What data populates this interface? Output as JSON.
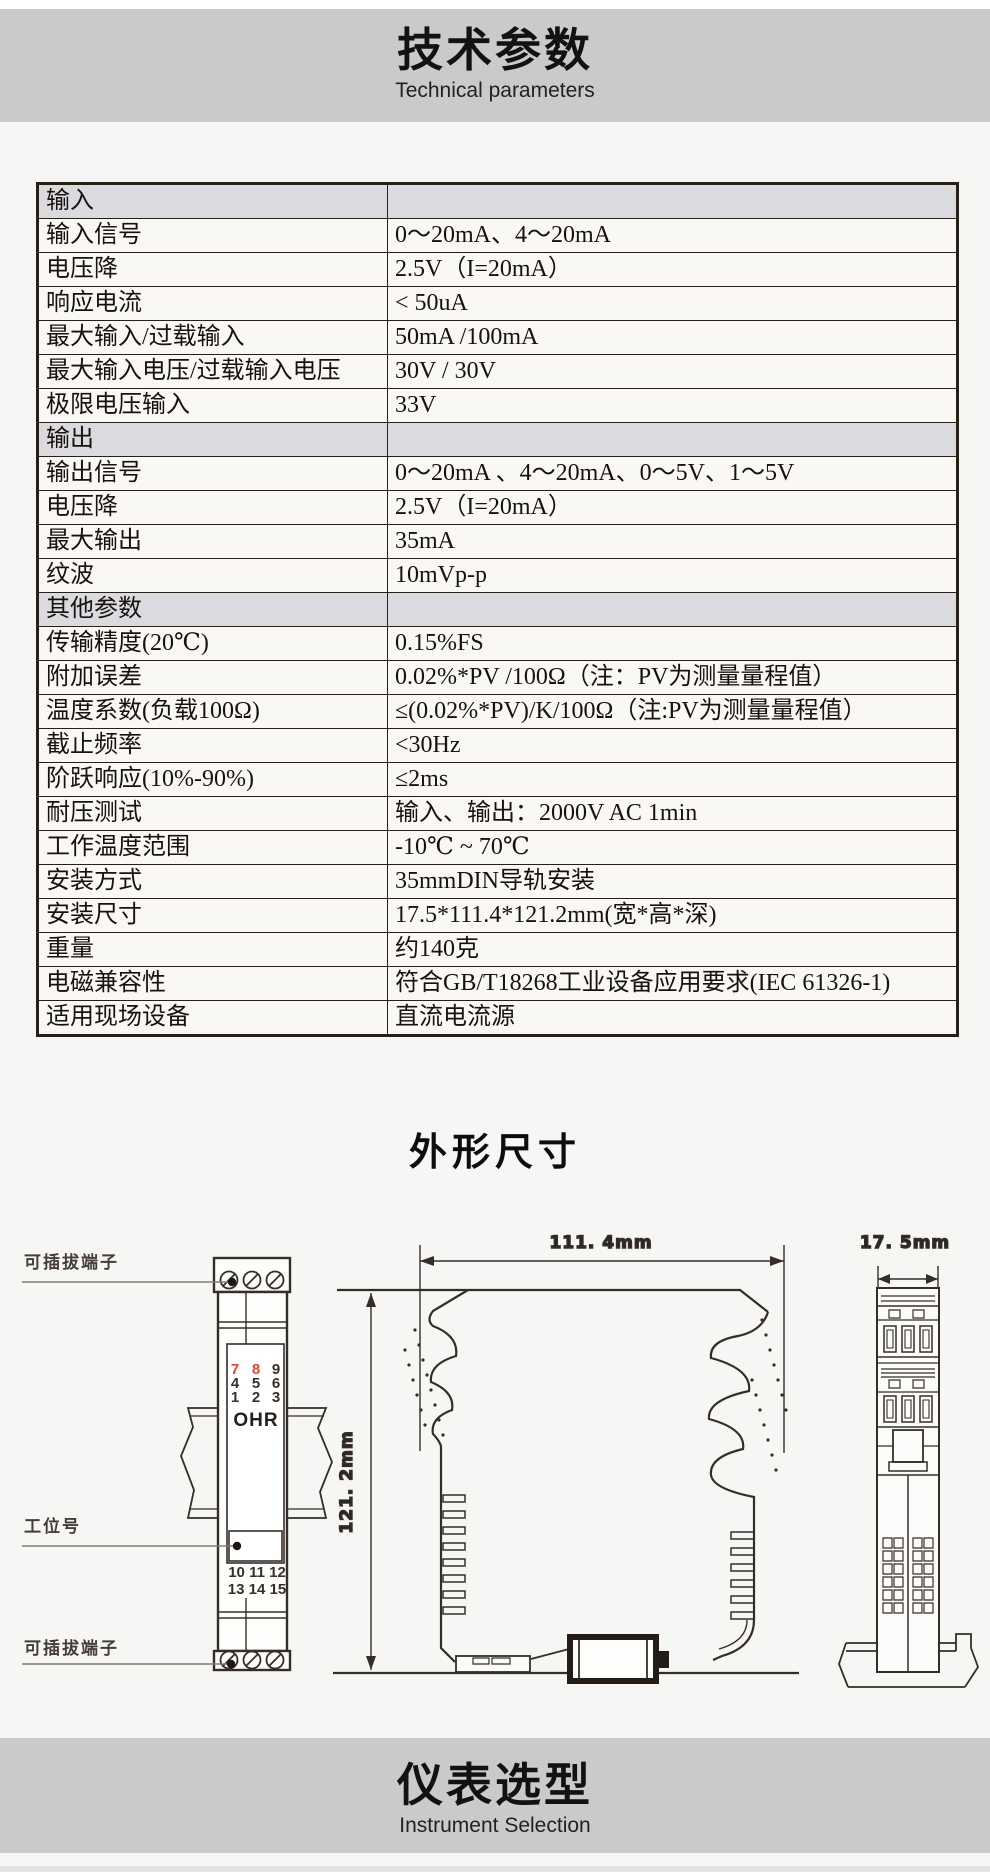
{
  "banner_top": {
    "title": "技术参数",
    "subtitle": "Technical parameters"
  },
  "section_dimensions": {
    "title": "外形尺寸"
  },
  "banner_bottom": {
    "title": "仪表选型",
    "subtitle": "Instrument Selection"
  },
  "table": {
    "rows": [
      {
        "label": "输入",
        "value": "",
        "section": true
      },
      {
        "label": "输入信号",
        "value": "0～20mA、4～20mA",
        "section": false
      },
      {
        "label": "电压降",
        "value": "2.5V（I=20mA）",
        "section": false
      },
      {
        "label": "响应电流",
        "value": "< 50uA",
        "section": false
      },
      {
        "label": "最大输入/过载输入",
        "value": "50mA /100mA",
        "section": false
      },
      {
        "label": "最大输入电压/过载输入电压",
        "value": "30V / 30V",
        "section": false
      },
      {
        "label": "极限电压输入",
        "value": "33V",
        "section": false
      },
      {
        "label": "输出",
        "value": "",
        "section": true
      },
      {
        "label": "输出信号",
        "value": "0～20mA 、4～20mA、0～5V、1～5V",
        "section": false
      },
      {
        "label": "电压降",
        "value": "2.5V（I=20mA）",
        "section": false
      },
      {
        "label": "最大输出",
        "value": "35mA",
        "section": false
      },
      {
        "label": "纹波",
        "value": "10mVp-p",
        "section": false
      },
      {
        "label": "其他参数",
        "value": "",
        "section": true
      },
      {
        "label": "传输精度(20℃)",
        "value": "0.15%FS",
        "section": false
      },
      {
        "label": "附加误差",
        "value": "0.02%*PV /100Ω（注：PV为测量量程值）",
        "section": false
      },
      {
        "label": "温度系数(负载100Ω)",
        "value": "≤(0.02%*PV)/K/100Ω（注:PV为测量量程值）",
        "section": false
      },
      {
        "label": "截止频率",
        "value": "<30Hz",
        "section": false
      },
      {
        "label": "阶跃响应(10%-90%)",
        "value": "≤2ms",
        "section": false
      },
      {
        "label": "耐压测试",
        "value": "输入、输出：2000V AC  1min",
        "section": false
      },
      {
        "label": "工作温度范围",
        "value": "-10℃ ~ 70℃",
        "section": false
      },
      {
        "label": "安装方式",
        "value": "35mmDIN导轨安装",
        "section": false
      },
      {
        "label": "安装尺寸",
        "value": "17.5*111.4*121.2mm(宽*高*深)",
        "section": false
      },
      {
        "label": "重量",
        "value": "约140克",
        "section": false
      },
      {
        "label": "电磁兼容性",
        "value": "符合GB/T18268工业设备应用要求(IEC 61326-1)",
        "section": false
      },
      {
        "label": "适用现场设备",
        "value": "直流电流源",
        "section": false
      }
    ]
  },
  "diagram": {
    "front": {
      "label_pluggable_top": "可插拔端子",
      "label_tag": "工位号",
      "label_pluggable_bottom": "可插拔端子",
      "brand": "OHR",
      "grid": [
        "7",
        "8",
        "9",
        "4",
        "5",
        "6",
        "1",
        "2",
        "3"
      ],
      "bottom_row1": "10 11 12",
      "bottom_row2": "13 14 15"
    },
    "side": {
      "width": "111. 4mm",
      "height": "121. 2mm"
    },
    "top": {
      "width": "17. 5mm"
    }
  },
  "colors": {
    "banner": "#cacaca",
    "section_row": "#dbdbdf",
    "table_border": "#262019",
    "accent_red": "#e7452f",
    "diagram_stroke": "#352e28"
  }
}
